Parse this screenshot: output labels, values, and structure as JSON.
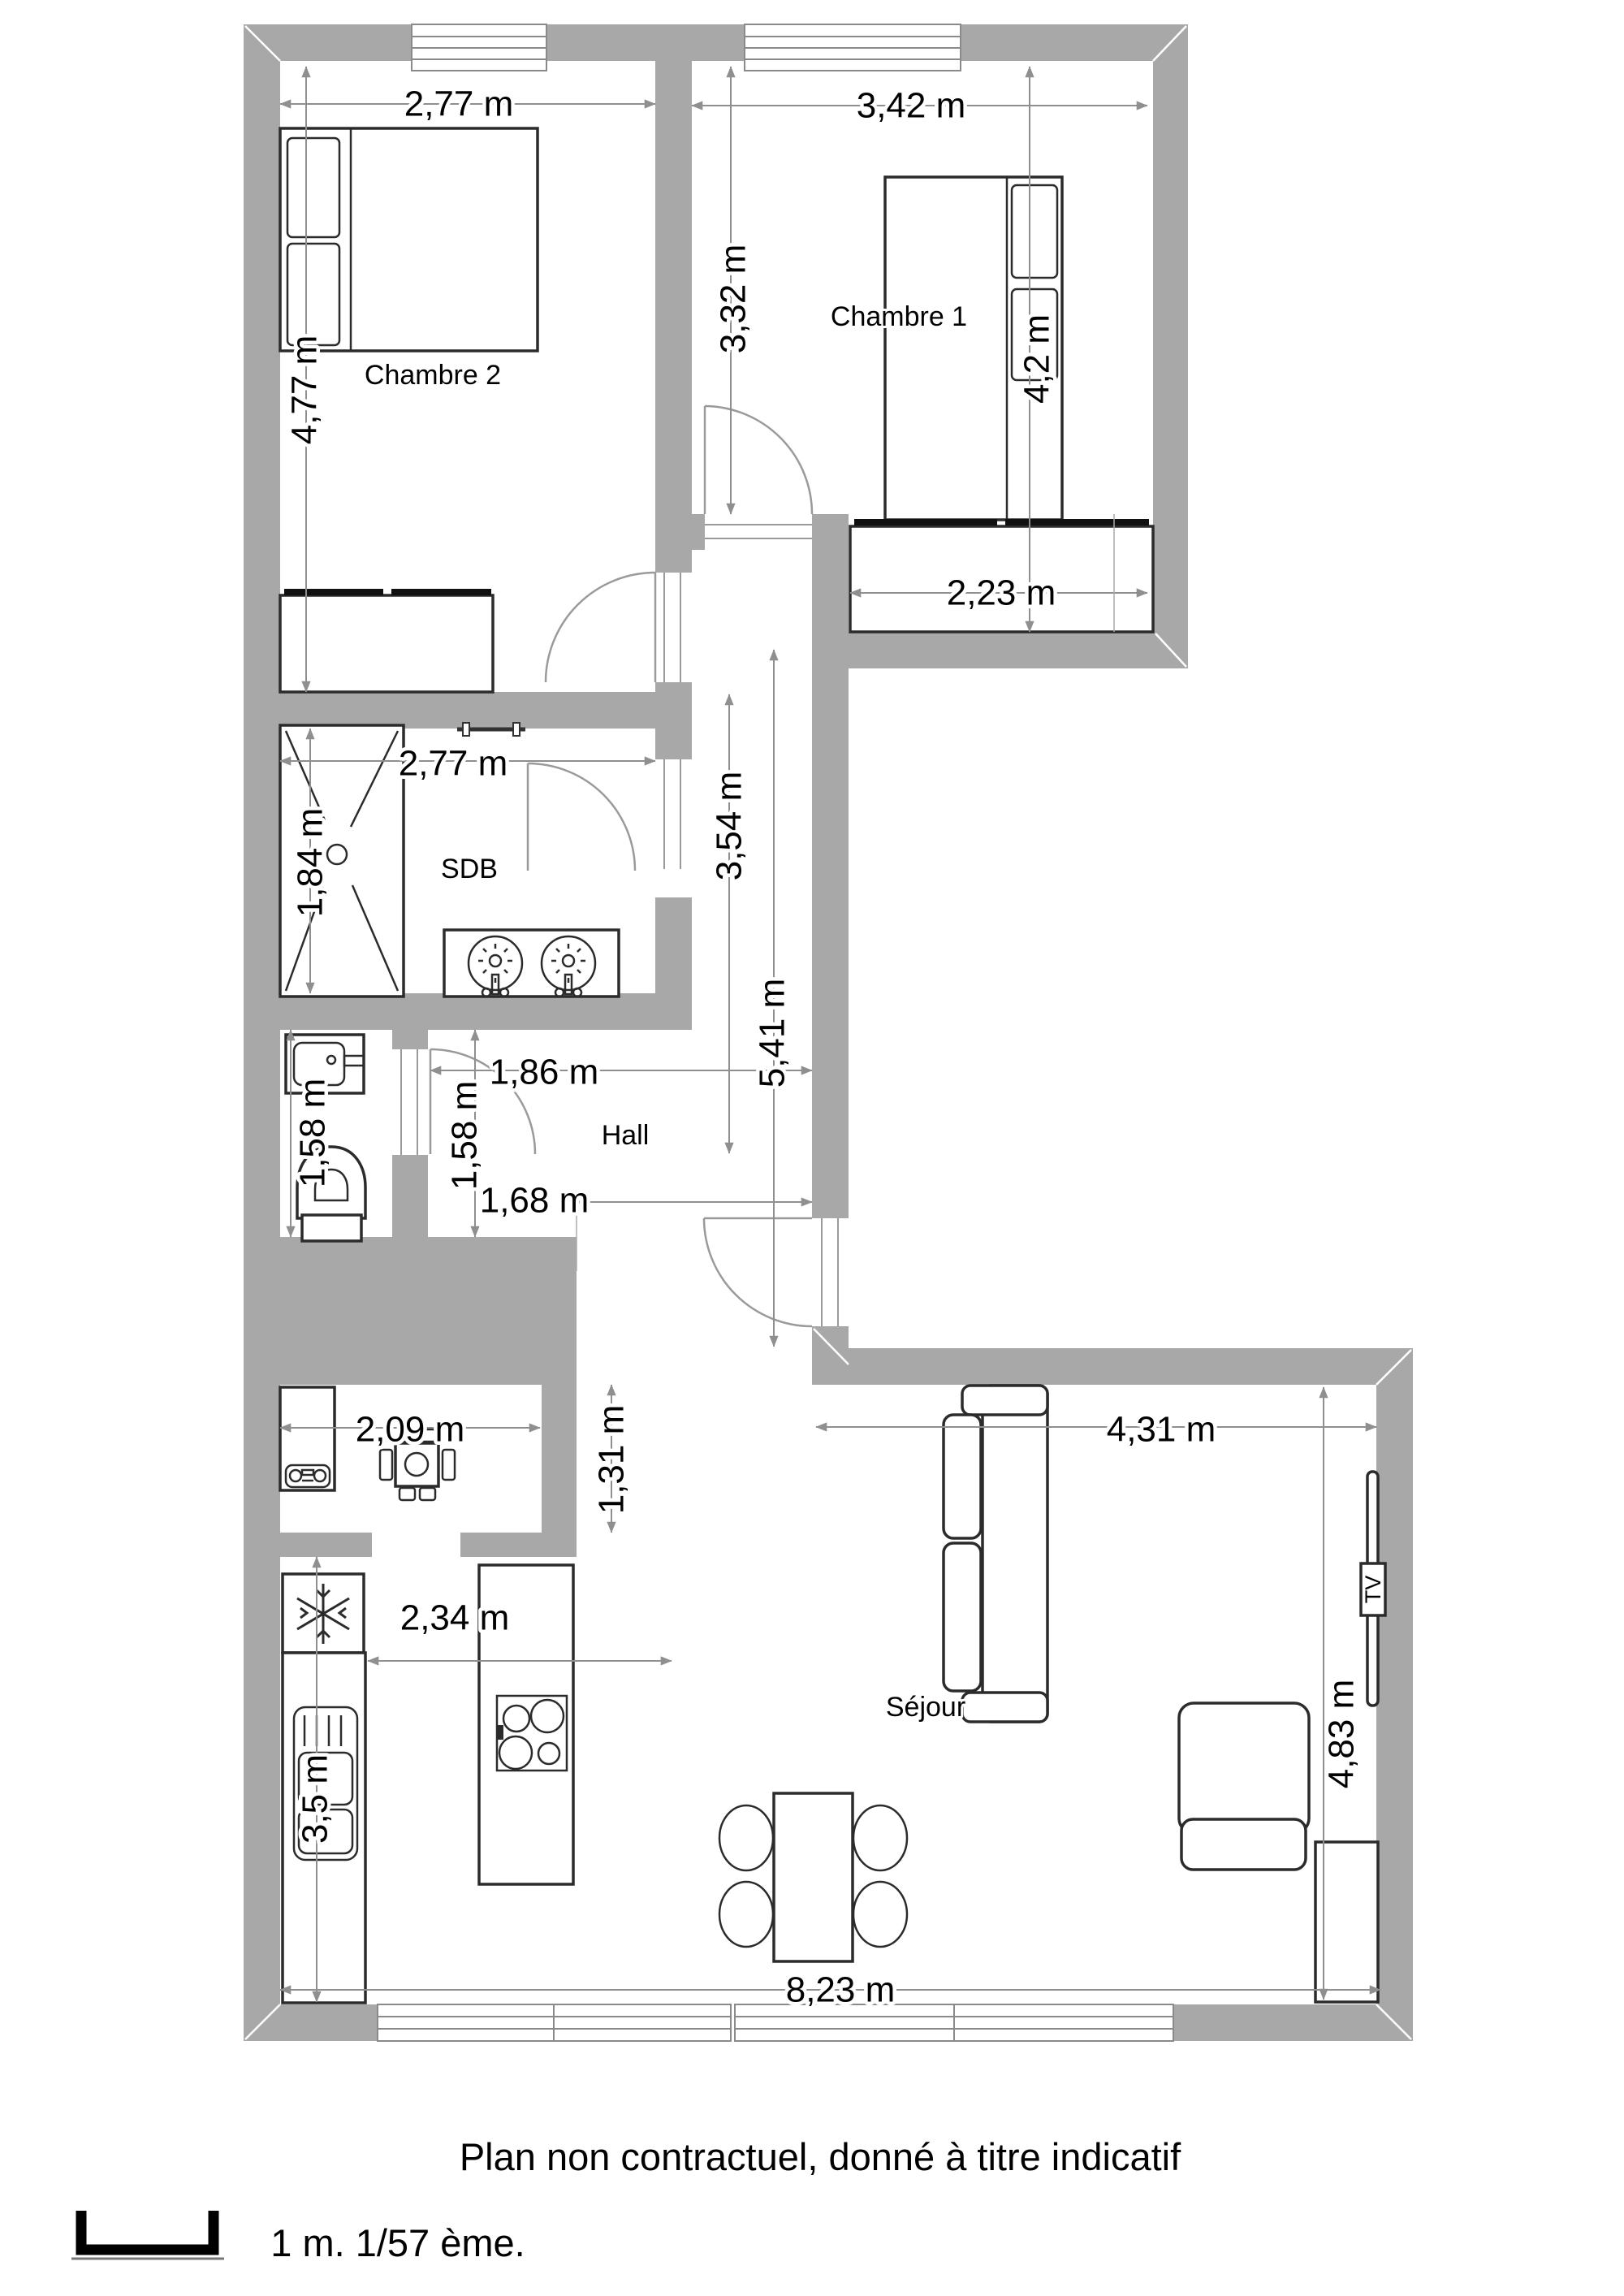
{
  "title": "Floor plan",
  "colors": {
    "wall": "#a8a8a8",
    "dimension_line": "#8f8f8f",
    "ink": "#000000"
  },
  "rooms": {
    "chambre2": "Chambre 2",
    "chambre1": "Chambre 1",
    "sdb": "SDB",
    "hall": "Hall",
    "sejour": "Séjour"
  },
  "dims": {
    "ch2_w": "2,77 m",
    "ch2_h": "4,77 m",
    "ch1_w": "3,42 m",
    "ch1_h": "3,32 m",
    "ch1_bed": "4,2 m",
    "closet": "2,23 m",
    "sdb_w": "2,77 m",
    "shower": "1,84 m",
    "corridor": "3,54 m",
    "hall_len": "5,41 m",
    "hall_w": "1,86 m",
    "wc_h": "1,58 m",
    "hall_h": "1,58 m",
    "hall_open": "1,68 m",
    "annex_w": "2,09 m",
    "annex_h": "1,31 m",
    "kitchen_w": "2,34 m",
    "kitchen_h": "3,5 m",
    "sejour_w": "4,31 m",
    "sejour_h": "4,83 m",
    "total_w": "8,23 m"
  },
  "tv": "TV",
  "footer": {
    "caption": "Plan non contractuel, donné à titre indicatif",
    "scale_note": "1 m. 1/57 ème."
  }
}
